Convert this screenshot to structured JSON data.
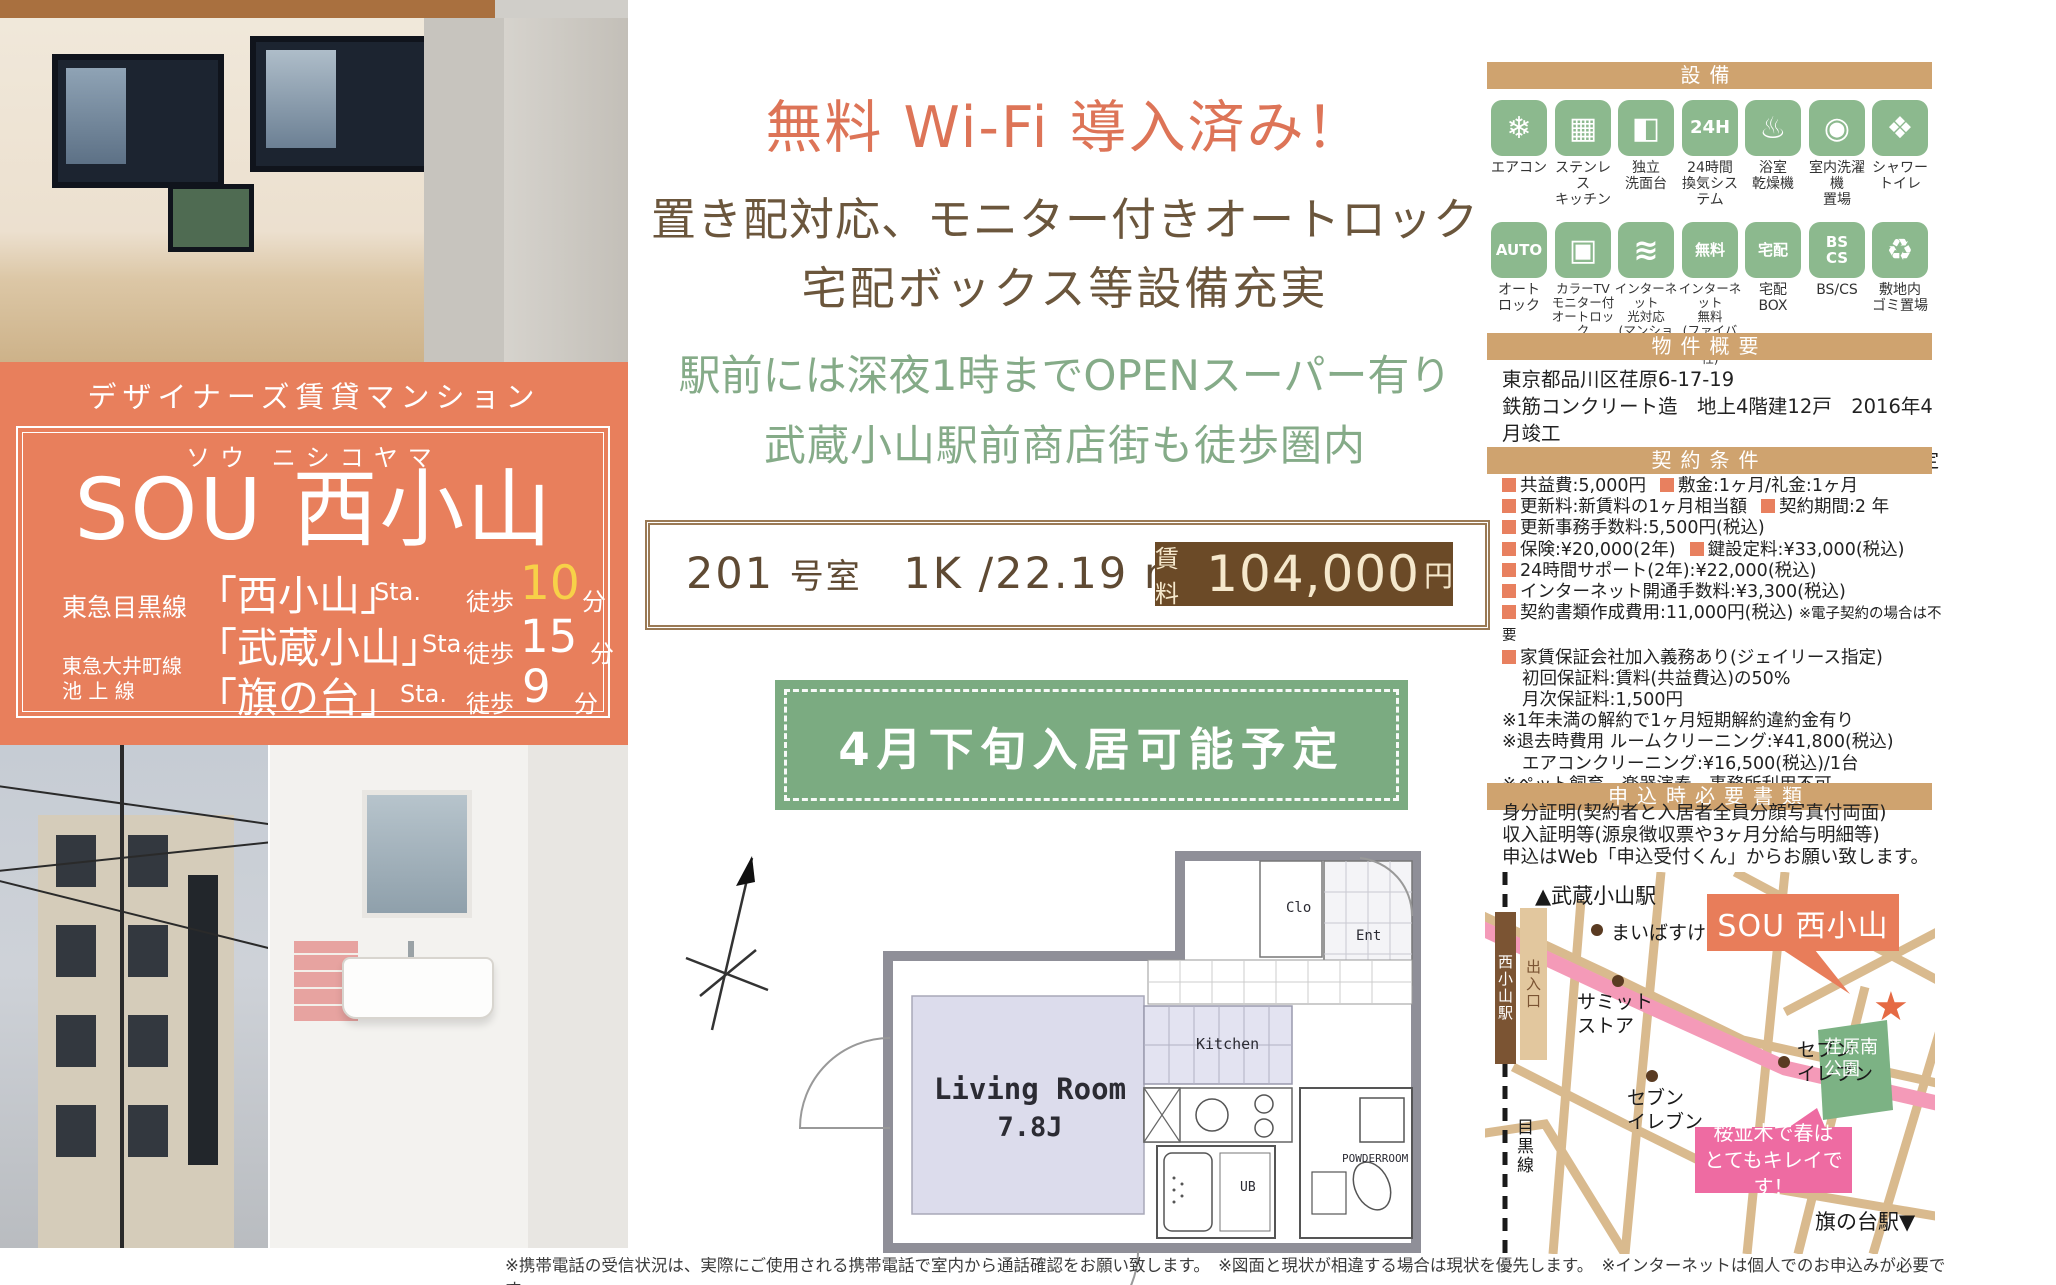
{
  "colors": {
    "accent_orange": "#e87f5c",
    "headline_orange": "#dd7457",
    "brown_text": "#6b563c",
    "green_text": "#85ab88",
    "tan_bar": "#cfa36f",
    "icon_green": "#8cb98e",
    "rent_box_brown": "#6b4a27",
    "banner_green": "#7bab81",
    "map_pink": "#ee6ba2",
    "park_green": "#7cb284",
    "walk10_yellow": "#f7d148"
  },
  "left": {
    "badge": "デザイナーズ賃貸マンション",
    "furigana": "ソウ ニシコヤマ",
    "name": "SOU 西小山",
    "access": [
      {
        "line": "東急目黒線",
        "station": "「西小山」",
        "sta": "Sta.",
        "walk": "徒歩",
        "min": "10",
        "unit": "分"
      },
      {
        "line": "",
        "station": "「武蔵小山」",
        "sta": "Sta.",
        "walk": "徒歩",
        "min": "15",
        "unit": "分"
      },
      {
        "line": "東急大井町線\n池 上 線",
        "station": "「旗の台」",
        "sta": "Sta.",
        "walk": "徒歩",
        "min": "9",
        "unit": "分"
      }
    ]
  },
  "center": {
    "headline_wifi": "無料 Wi-Fi 導入済み！",
    "headline_feature1": "置き配対応、モニター付きオートロック",
    "headline_feature2": "宅配ボックス等設備充実",
    "green_line1": "駅前には深夜1時までOPENスーパー有り",
    "green_line2": "武蔵小山駅前商店街も徒歩圏内",
    "room": {
      "no": "201",
      "no_suffix": "号室",
      "plan": "1K /22.19 m²"
    },
    "rent": {
      "label": "賃料",
      "value": "104,000",
      "unit": "円"
    },
    "move_in": "4月下旬入居可能予定"
  },
  "floorplan": {
    "living": "Living Room",
    "living_size": "7.8J",
    "kitchen": "Kitchen",
    "clo": "Clo",
    "ent": "Ent",
    "ub": "UB",
    "powder": "POWDERROOM"
  },
  "equipment": {
    "title": "設備",
    "items": [
      {
        "label": "エアコン",
        "glyph": "❄"
      },
      {
        "label": "ステンレス\nキッチン",
        "glyph": "▦"
      },
      {
        "label": "独立\n洗面台",
        "glyph": "◧"
      },
      {
        "label": "24時間\n換気システム",
        "glyph": "24H"
      },
      {
        "label": "浴室\n乾燥機",
        "glyph": "♨"
      },
      {
        "label": "室内洗濯機\n置場",
        "glyph": "◉"
      },
      {
        "label": "シャワー\nトイレ",
        "glyph": "❖"
      },
      {
        "label": "オート\nロック",
        "glyph": "AUTO"
      },
      {
        "label": "カラーTV\nモニター付\nオートロック",
        "glyph": "▣"
      },
      {
        "label": "インターネット\n光対応\n(マンションタイプ)",
        "glyph": "≋"
      },
      {
        "label": "インターネット\n無料\n(ファイバーゲート社)",
        "glyph": "無料"
      },
      {
        "label": "宅配\nBOX",
        "glyph": "宅配"
      },
      {
        "label": "BS/CS",
        "glyph": "BS\nCS"
      },
      {
        "label": "敷地内\nゴミ置場",
        "glyph": "♻"
      }
    ]
  },
  "overview": {
    "title": "物件概要",
    "lines": [
      "東京都品川区荏原6-17-19",
      "鉄筋コンクリート造　地上4階建12戸　2016年4月竣工",
      "退去済み(クリーニング中)　4月下旬入居可能予定"
    ]
  },
  "terms": {
    "title": "契約条件",
    "rows": [
      {
        "a": "共益費:5,000円",
        "b": "敷金:1ヶ月/礼金:1ヶ月"
      },
      {
        "a": "更新料:新賃料の1ヶ月相当額",
        "b": "契約期間:2 年"
      },
      {
        "a": "更新事務手数料:5,500円(税込)"
      },
      {
        "a": "保険:¥20,000(2年)",
        "b": "鍵設定料:¥33,000(税込)"
      },
      {
        "a": "24時間サポート(2年):¥22,000(税込)"
      },
      {
        "a": "インターネット開通手数料:¥3,300(税込)"
      },
      {
        "a": "契約書類作成費用:11,000円(税込)",
        "note": "※電子契約の場合は不要"
      },
      {
        "a": "家賃保証会社加入義務あり(ジェイリース指定)"
      },
      {
        "plain": "初回保証料:賃料(共益費込)の50%"
      },
      {
        "plain": "月次保証料:1,500円"
      },
      {
        "plain": "※1年未満の解約で1ヶ月短期解約違約金有り"
      },
      {
        "plain": "※退去時費用 ルームクリーニング:¥41,800(税込)"
      },
      {
        "plain": "エアコンクリーニング:¥16,500(税込)/1台"
      },
      {
        "plain": "※ペット飼育、楽器演奏、事務所利用不可"
      }
    ]
  },
  "documents": {
    "title": "申込時必要書類",
    "lines": [
      "身分証明(契約者と入居者全員分顔写真付両面)",
      "収入証明等(源泉徴収票や3ヶ月分給与明細等)",
      "申込はWeb「申込受付くん」からお願い致します。"
    ]
  },
  "map": {
    "musashikoyama": "▲武蔵小山駅",
    "nishikoyama_sta": "西小山駅",
    "exit": "出入口",
    "maibasuketto": "まいばすけっと",
    "summit": "サミット\nストア",
    "seven1": "セブン\nイレブン",
    "seven2": "セブン\nイレブン",
    "property": "SOU 西小山",
    "park": "荏原南\n公園",
    "sakura": "桜並木で春は\nとてもキレイです！",
    "meguro_line": "目黒線",
    "hatanodai": "旗の台駅▼",
    "star": "★"
  },
  "footer": "※携帯電話の受信状況は、実際にご使用される携帯電話で室内から通話確認をお願い致します。　※図面と現状が相違する場合は現状を優先します。　※インターネットは個人でのお申込みが必要です。"
}
